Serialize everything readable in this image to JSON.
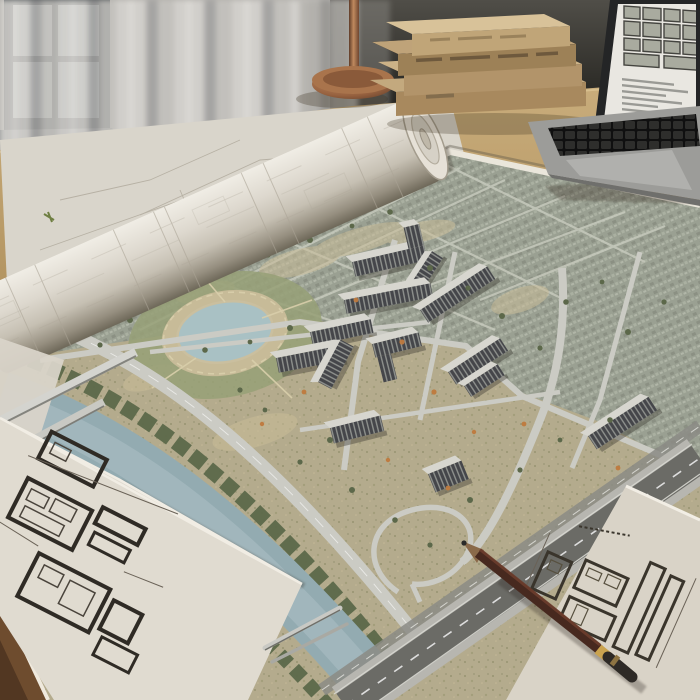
{
  "scene": {
    "setting": {
      "label": "architects-desk-scene"
    },
    "window": {
      "label": "window with sheer curtains"
    },
    "desk": {
      "label": "wooden desk surface"
    },
    "lamp": {
      "label": "copper desk lamp base"
    },
    "books": {
      "label": "stack of hardcover books",
      "count": 4
    },
    "laptop": {
      "label": "laptop showing a site plan document"
    },
    "blueprint_roll": {
      "label": "rolled-up blueprint sheet"
    },
    "masterplan": {
      "label": "aerial masterplan rendering of residential development",
      "features": [
        "apartment buildings",
        "pond with park",
        "river with tree banks",
        "embankment road",
        "highway with ramp loop",
        "existing city fabric"
      ],
      "building_count": 13
    },
    "floorplan_sheet_left": {
      "label": "floor plan blueprint sheet (bottom left)"
    },
    "floorplan_sheet_right": {
      "label": "floor plan blueprint sheet (bottom right)"
    },
    "pencil": {
      "label": "dark wooden pencil with gold band"
    },
    "pens": {
      "label": "two metal pens",
      "count": 2
    },
    "rulers": {
      "label": "metal straightedge rulers",
      "count": 2
    }
  },
  "palette": {
    "city": "#9aa092",
    "ground": "#b4ab8d",
    "roof": "#d7d6cf",
    "facade": "#45464a",
    "sheet": "#e0dbd0",
    "pond": "#a9c1c4",
    "trees": "#5c684a",
    "water": "#93abb1",
    "road": "#cbcbc4",
    "highway": "#6b6b66",
    "desk": "#ab8e60",
    "copper": "#a9744c",
    "book": "#b2946a",
    "pencil": "#47291f",
    "curtain": "#d7d5d1",
    "accent": "#bf7a3e"
  }
}
